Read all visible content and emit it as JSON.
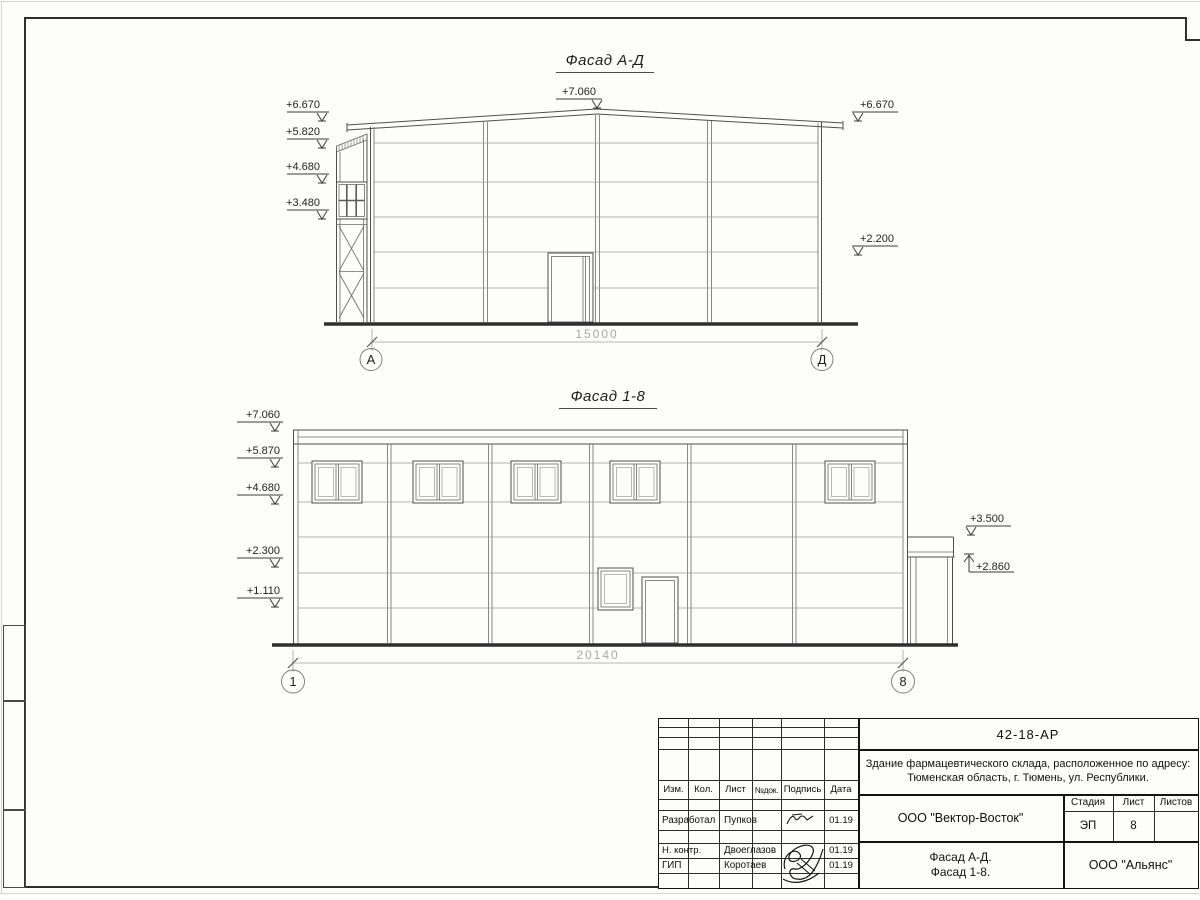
{
  "facade_ad": {
    "title": "Фасад А-Д",
    "elev_left": [
      "+6.670",
      "+5.820",
      "+4.680",
      "+3.480"
    ],
    "elev_top": "+7.060",
    "elev_right_top": "+6.670",
    "elev_right_mid": "+2.200",
    "dim": "15000",
    "axis_left": "А",
    "axis_right": "Д"
  },
  "facade_18": {
    "title": "Фасад 1-8",
    "elev_left": [
      "+7.060",
      "+5.870",
      "+4.680",
      "+2.300",
      "+1.110"
    ],
    "elev_right_top": "+3.500",
    "elev_right_bottom": "+2.860",
    "dim": "20140",
    "axis_left": "1",
    "axis_right": "8"
  },
  "title_block": {
    "code": "42-18-АР",
    "description": [
      "Здание фармацевтического склада, расположенное по адресу:",
      "Тюменская область, г. Тюмень, ул. Республики."
    ],
    "cols": [
      "Изм.",
      "Кол.",
      "Лист",
      "№док.",
      "Подпись",
      "Дата"
    ],
    "rows": [
      {
        "role": "Разработал",
        "name": "Пупков",
        "date": "01.19"
      },
      {
        "role": "Н. контр.",
        "name": "Двоеглазов",
        "date": "01.19"
      },
      {
        "role": "ГИП",
        "name": "Коротаев",
        "date": "01.19"
      }
    ],
    "contractor": "ООО \"Вектор-Восток\"",
    "stage_label": "Стадия",
    "sheet_label": "Лист",
    "sheets_label": "Листов",
    "stage": "ЭП",
    "sheet_no": "8",
    "sheets_total": "",
    "sheet_title": [
      "Фасад А-Д.",
      "Фасад 1-8."
    ],
    "client": "ООО \"Альянс\""
  }
}
